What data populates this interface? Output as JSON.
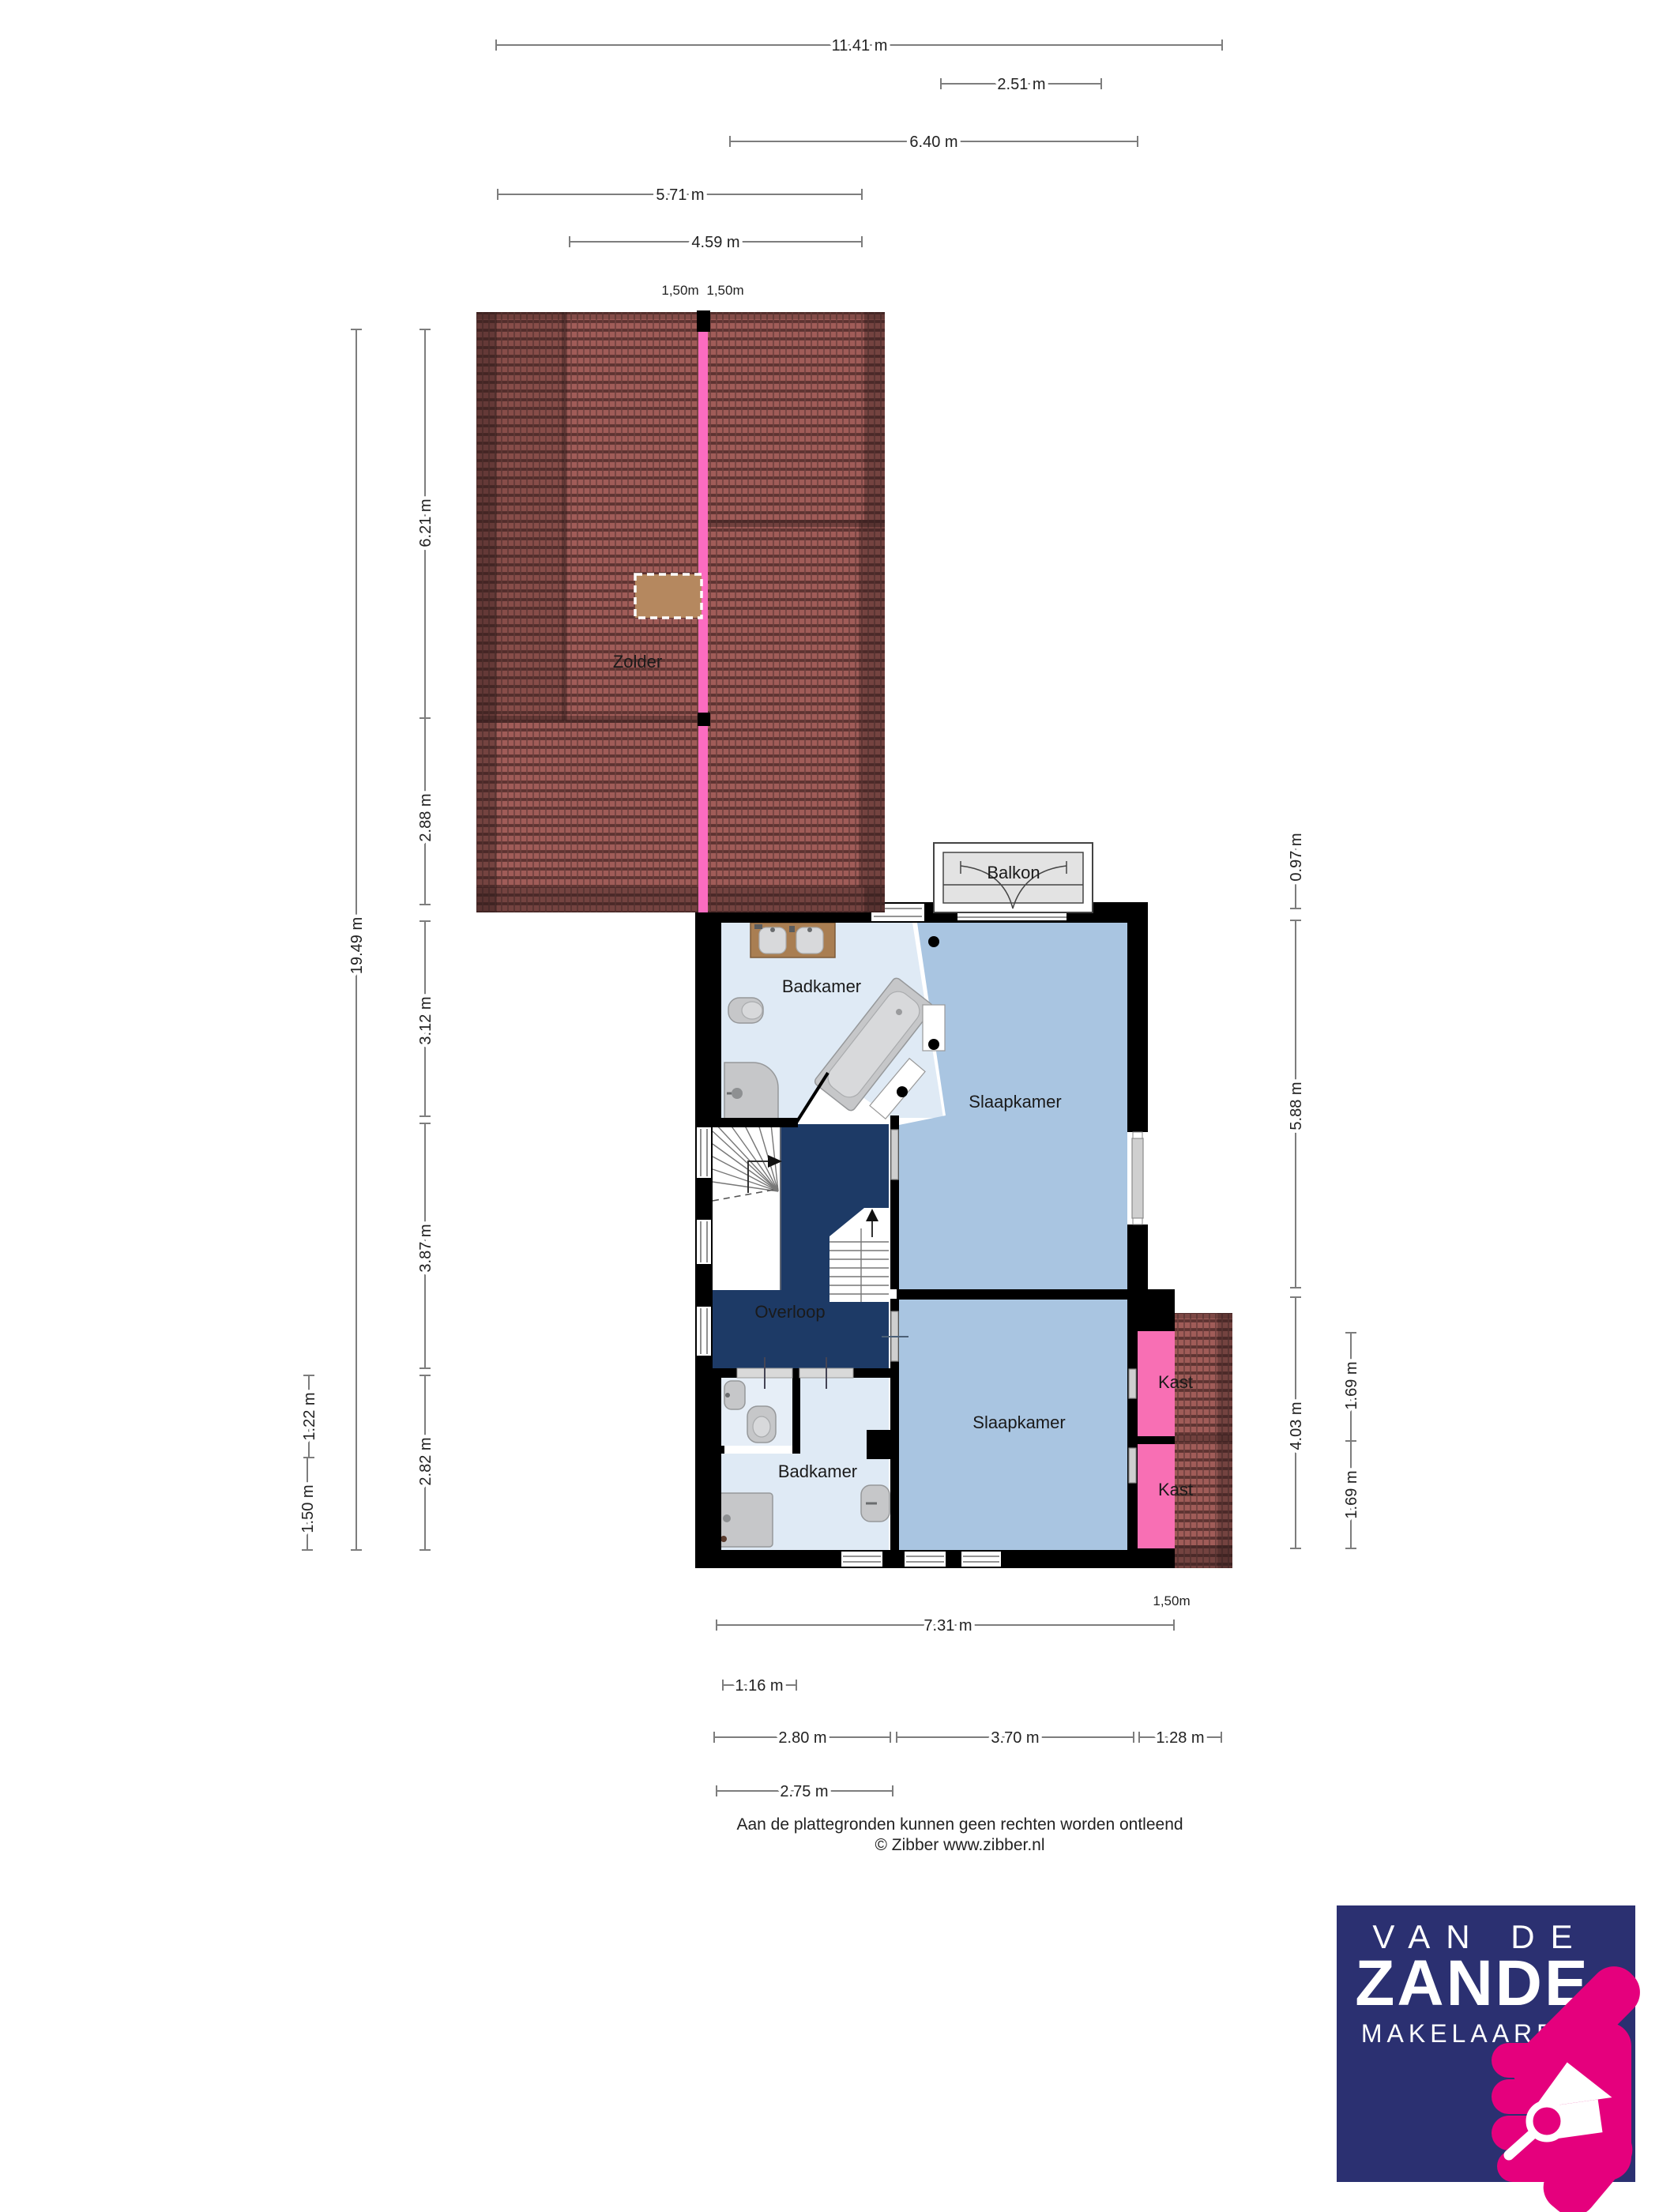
{
  "document": {
    "type": "floorplan",
    "floor": "first floor"
  },
  "colors": {
    "wall": "#000000",
    "bedroom_floor": "#a9c5e1",
    "bathroom_floor": "#dfeaf5",
    "hall_floor": "#1d3a66",
    "closet_floor": "#f86fb4",
    "balcony_floor": "#e3e3e3",
    "roof_tile": "#a05c58",
    "roof_tile_dark": "#5d3331",
    "roof_ridge_pink": "#fb6cc0",
    "skylight_tan": "#b5885f",
    "dimension_line": "#7d7d7d",
    "logo_navy": "#2b3071",
    "logo_pink": "#e5007d"
  },
  "rooms": {
    "zolder": "Zolder",
    "badkamer_boven": "Badkamer",
    "slaapkamer_1": "Slaapkamer",
    "balkon": "Balkon",
    "overloop": "Overloop",
    "slaapkamer_2": "Slaapkamer",
    "badkamer_beneden": "Badkamer",
    "kast_1": "Kast",
    "kast_2": "Kast"
  },
  "dims": {
    "top": [
      {
        "label": "11.41 m"
      },
      {
        "label": "2.51 m"
      },
      {
        "label": "6.40 m"
      },
      {
        "label": "5.71 m"
      },
      {
        "label": "4.59 m"
      }
    ],
    "top_small": [
      {
        "label": "1,50m"
      },
      {
        "label": "1,50m"
      }
    ],
    "left": [
      {
        "label": "19.49 m"
      },
      {
        "label": "6.21 m"
      },
      {
        "label": "2.88 m"
      },
      {
        "label": "3.12 m"
      },
      {
        "label": "3.87 m"
      },
      {
        "label": "2.82 m"
      },
      {
        "label": "1.22 m"
      },
      {
        "label": "1.50 m"
      }
    ],
    "right": [
      {
        "label": "0.97 m"
      },
      {
        "label": "5.88 m"
      },
      {
        "label": "4.03 m"
      },
      {
        "label": "1.69 m"
      },
      {
        "label": "1.69 m"
      }
    ],
    "bottom": [
      {
        "label": "7.31 m"
      },
      {
        "label": "1.16 m"
      },
      {
        "label": "2.80 m"
      },
      {
        "label": "3.70 m"
      },
      {
        "label": "1.28 m"
      },
      {
        "label": "2.75 m"
      }
    ],
    "floating": {
      "label": "1,50m"
    }
  },
  "footer": {
    "line1": "Aan de plattegronden kunnen geen rechten worden ontleend",
    "line2": "© Zibber www.zibber.nl"
  },
  "logo": {
    "line1": "VAN DE",
    "line2": "ZANDE",
    "line3": "MAKELAARDIJ"
  }
}
